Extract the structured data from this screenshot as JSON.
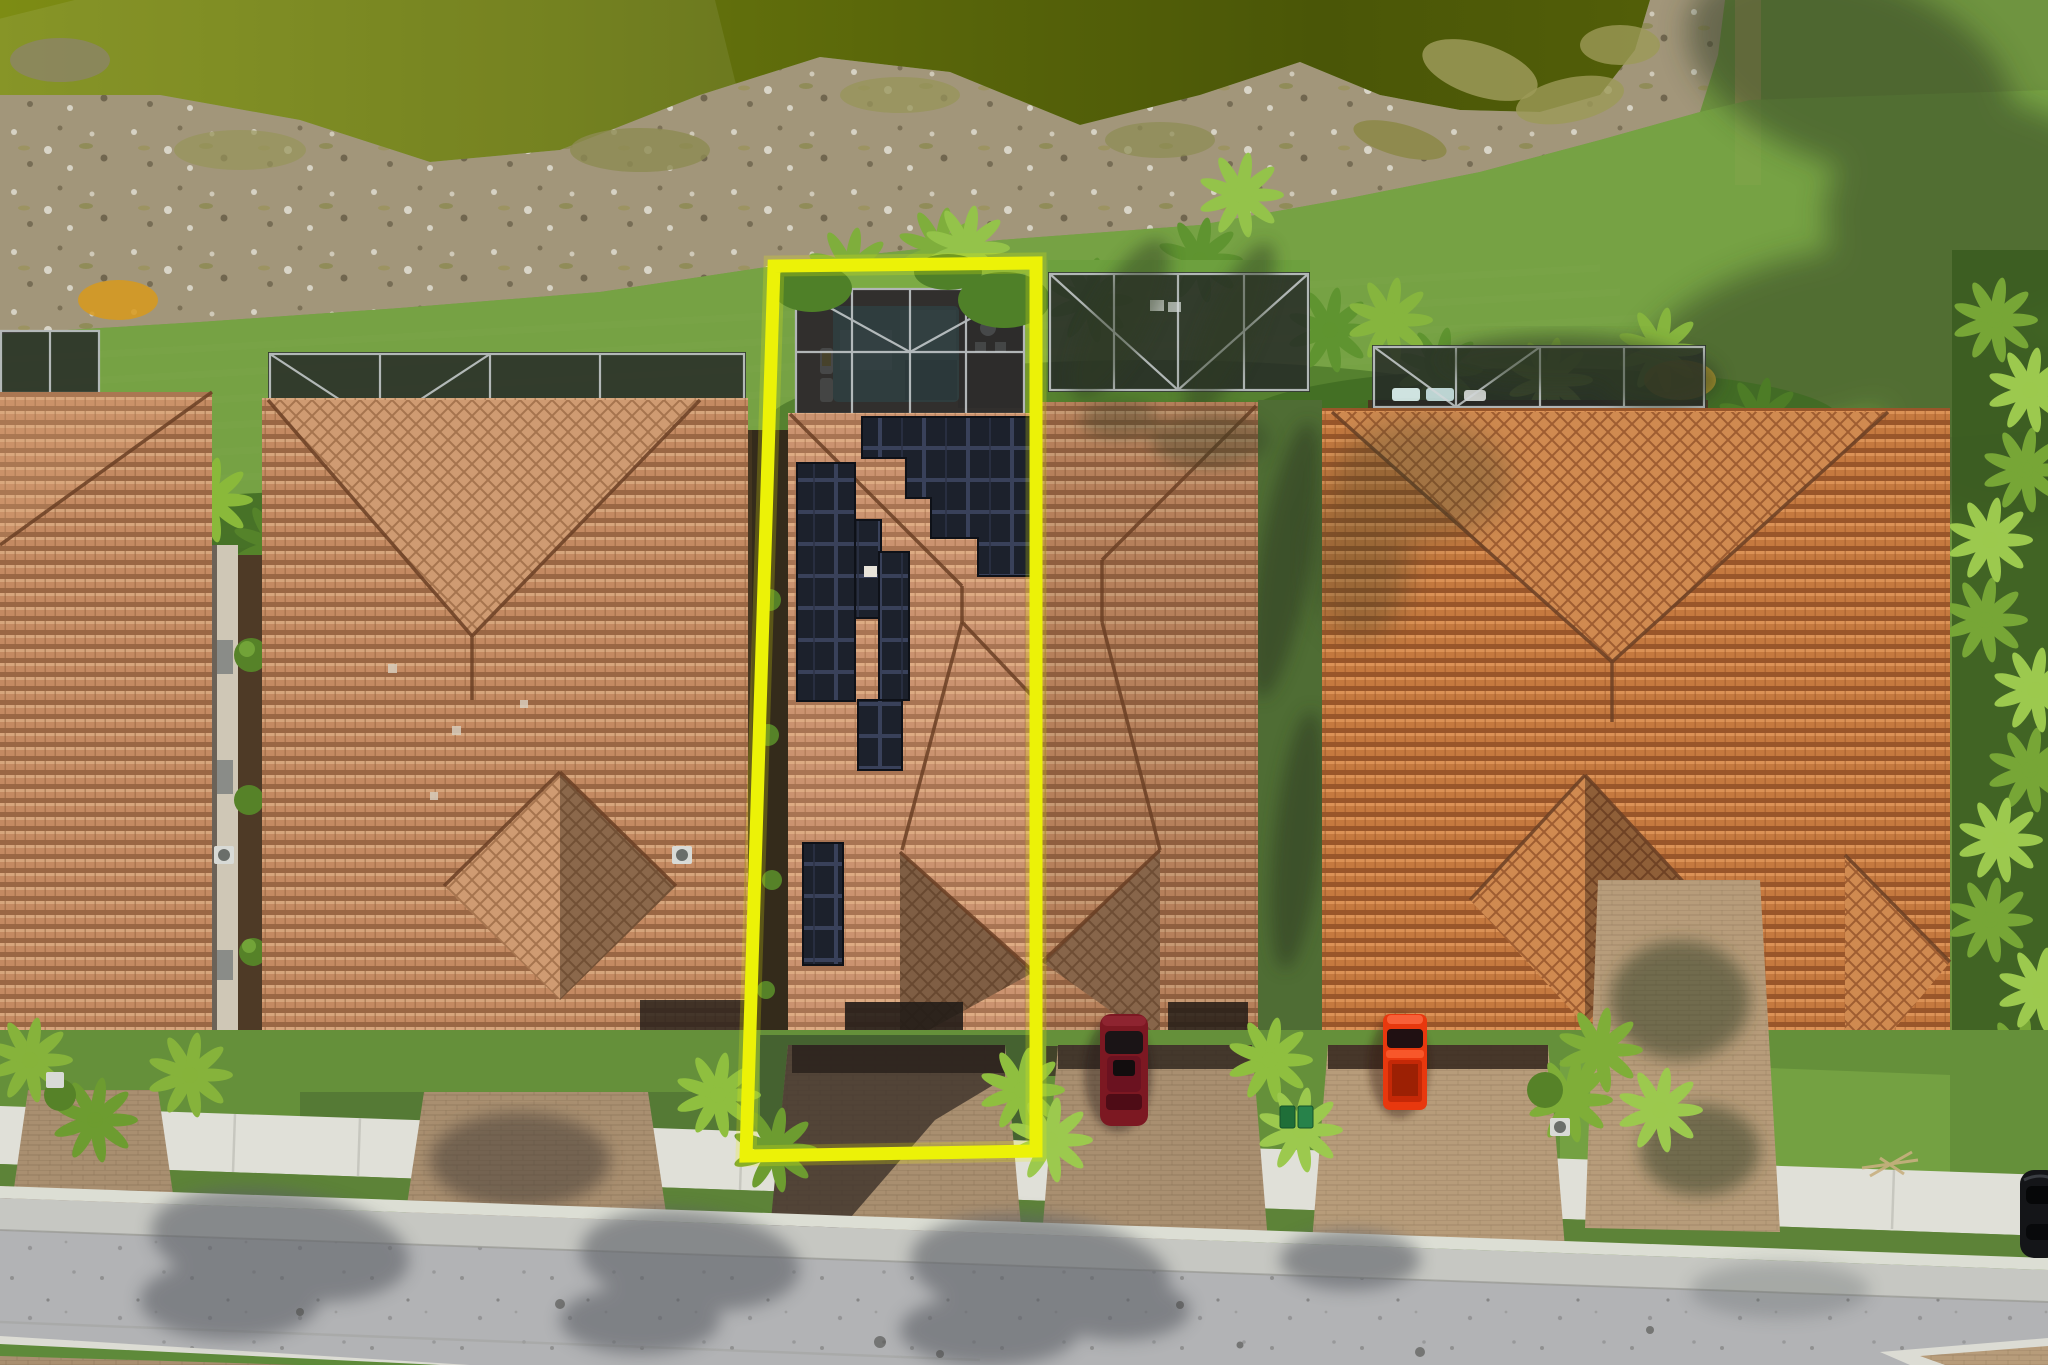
{
  "meta": {
    "description": "Aerial drone photograph of a row of Mediterranean tile-roof villas; the center narrow lot is outlined in yellow and has rooftop solar panels and a screened pool enclosure",
    "image_width": 2048,
    "image_height": 1365,
    "visible_text": "none"
  },
  "colors": {
    "c-grass": "#6f9440",
    "c-grass-light": "#78a445",
    "c-grass-dark": "#49682e",
    "c-pond": "#65730d",
    "c-pond-dark": "#46520a",
    "c-bank": "#a2967a",
    "c-veg": "#3f6a22",
    "c-veg-light": "#8fbf3f",
    "c-tile": "#c48a62",
    "c-tile-light": "#cb9370",
    "c-tile-orange": "#c5793f",
    "c-ridge": "#6b3f24",
    "c-solar": "#1c212c",
    "c-mesh": "#232627",
    "c-frame": "#d3d8da",
    "c-pool": "#63a4a8",
    "c-deck": "#6e5947",
    "c-sidewalk": "#e0e0d8",
    "c-curb": "#dcded4",
    "c-road": "#b2b3b5",
    "c-paver": "#a98f70",
    "c-mulch": "#4e3a26",
    "c-bush": "#568228",
    "c-boundary": "#ecf207",
    "c-car-maroon": "#7c1822",
    "c-car-red": "#e8380e",
    "c-car-dark": "#141518"
  },
  "scene": {
    "boundary_lot": {
      "shape": "tall rectangle outline",
      "color": "#ecf207",
      "contents": [
        "screened pool enclosure",
        "rectangular pool",
        "tile roof with solar array",
        "shaded paver driveway",
        "palm landscaping"
      ]
    },
    "houses": [
      {
        "id": "partial-left-house",
        "position": "left edge, partially cropped",
        "roof": "salmon terracotta tile hip roof"
      },
      {
        "id": "left-house",
        "position": "left",
        "roof": "salmon terracotta tile, V-valley and front gable",
        "pool_cage": true
      },
      {
        "id": "highlighted-house",
        "position": "center, inside yellow boundary",
        "roof": "terracotta tile with black solar panel staircase array",
        "pool_cage": true,
        "pool": true
      },
      {
        "id": "middle-house",
        "position": "right of highlighted",
        "roof": "terracotta tile hip",
        "pool_cage": true
      },
      {
        "id": "right-house",
        "position": "right",
        "roof": "orange terracotta tile, V-valley and gables",
        "pool_cage": true
      }
    ],
    "vehicles": [
      {
        "id": "maroon-suv",
        "color": "#7c1822",
        "location": "middle house driveway"
      },
      {
        "id": "red-pickup",
        "color": "#e8380e",
        "location": "right house driveway"
      },
      {
        "id": "dark-car",
        "color": "#141518",
        "location": "road, far right edge"
      }
    ],
    "environment": {
      "pond": "olive-green water band across top",
      "shoreline": "rocky sand bank with dry grass tufts",
      "grass_strip": "mowed green band behind lots",
      "vegetation": "row of palms and shrubs behind pool cages",
      "street": "light gray asphalt with palm frond shadows, white sidewalk and curb",
      "driveways": "tan brick pavers crossing the sidewalk"
    }
  }
}
